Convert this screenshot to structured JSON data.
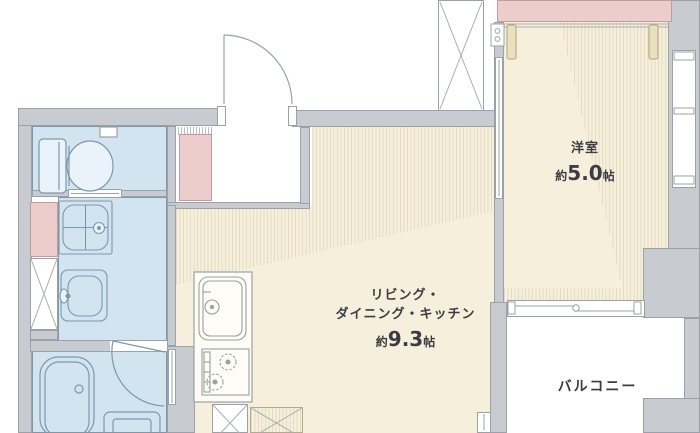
{
  "floorplan": {
    "rooms": {
      "western_room": {
        "name": "洋室",
        "size_prefix": "約",
        "size_value": "5.0",
        "size_unit": "帖"
      },
      "ldk": {
        "name_line1": "リビング・",
        "name_line2": "ダイニング・キッチン",
        "size_prefix": "約",
        "size_value": "9.3",
        "size_unit": "帖"
      },
      "balcony": {
        "name": "バルコニー"
      }
    },
    "fixtures": {
      "toilet": "toilet-icon",
      "washing_machine_pan": "washing-machine-pan-icon",
      "washbasin": "washbasin-icon",
      "bathtub": "bathtub-icon",
      "kitchen_sink": "kitchen-sink-icon",
      "stove": "stove-icon",
      "entrance_door": "door-swing-icon",
      "bathroom_door": "door-swing-icon",
      "balcony_sliding_window": "sliding-window-icon",
      "pipe_shaft": "x-brace-icon",
      "refrigerator_space": "x-box-icon"
    },
    "colors": {
      "wall": "#c8ccd1",
      "wall_outline": "#9ba1a9",
      "floor": "#f5efdb",
      "hatch": "#e3dcc3",
      "wet_area": "#d2e4f0",
      "fixture_outline": "#7d97ab",
      "closet": "#edcdcb",
      "closet_outline": "#c49c9b",
      "balcony_floor": "#ffffff",
      "text": "#3c3c42"
    }
  }
}
